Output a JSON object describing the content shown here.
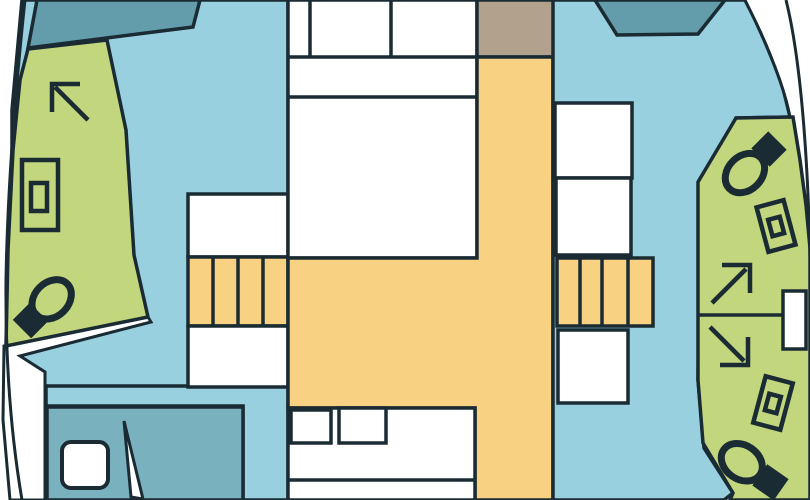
{
  "figure": {
    "kind": "boat-floor-plan",
    "icon_names": [
      "toilet-icon",
      "sink-icon",
      "shower-arrow-icon",
      "hatch-icon",
      "door-icon",
      "stairs",
      "window"
    ]
  },
  "colors": {
    "outline": "#1a2b33",
    "deck_white": "#ffffff",
    "cabin_blue": "#99d0e0",
    "window_teal": "#639dab",
    "berth_teal": "#7ab1bf",
    "head_green": "#c2d67e",
    "salon_yellow": "#f8d183",
    "hatch_tan": "#b2a18d"
  },
  "shapes": {
    "left_outer_deck": {
      "d": "M25,0 Q8,160 6,280 Q5,400 22,500 L0,500 L0,0 Z"
    },
    "left_hull_line": {
      "d": "M25,0 Q8,160 6,280 Q5,400 22,500"
    },
    "left_cabin": {
      "points": "22,0 288,0 288,500 243,500 243,406 46,406 46,386 12,386 12,110"
    },
    "left_gunwale": {
      "points": "4,346 148,317 151,322 20,356 45,372 45,500 10,500 3,420"
    },
    "left_head": {
      "points": "28,49 107,40 126,130 134,255 148,317 6,346 8,250 13,150 20,80"
    },
    "left_window": {
      "points": "37,0 200,0 193,27 28,48"
    },
    "left_cabin_divider": {
      "d": "M45,386 H188"
    },
    "left_berth": {
      "points": "47,407 243,407 243,500 47,500"
    },
    "berth_hatch": {
      "d": "M71,442 h28 a9,9 0 0 1 9,9 v28 a9,9 0 0 1 -9,9 h-28 a9,9 0 0 1 -9,-9 v-28 a9,9 0 0 1 9,-9 Z"
    },
    "berth_door": {
      "points": "124,421 131,497 143,499"
    },
    "left_landing_top": {
      "points": "188,194 288,194 288,257 188,257"
    },
    "left_stairs": {
      "points": "188,257 288,257 288,326 188,326"
    },
    "left_stairs_treads": {
      "d": "M213,257 V326 M238,257 V326 M263,257 V326"
    },
    "left_landing_bottom": {
      "points": "188,326 288,326 288,387 188,387"
    },
    "bed": {
      "points": "288,0 477,0 477,258 288,258"
    },
    "bed_lines": {
      "d": "M310,0 V57 M391,0 V57 M288,57 H477 M288,97 H477"
    },
    "bow_hatch": {
      "points": "477,0 558,0 558,57 477,57"
    },
    "saloon": {
      "points": "477,57 553,57 553,500 475,500 475,408 288,408 288,258 477,258"
    },
    "galley": {
      "points": "288,408 475,408 475,500 288,500"
    },
    "galley_divider": {
      "d": "M288,480 H475"
    },
    "galley_sink_left": {
      "points": "291,410 331,410 331,443 291,443"
    },
    "galley_sink_right": {
      "points": "339,408 386,408 386,443 339,443"
    },
    "right_cabin": {
      "points": "553,0 745,0 763,35 781,80 790,117 736,118 700,182 698,380 704,448 733,493 724,500 553,500"
    },
    "right_window": {
      "points": "595,0 725,0 698,34 617,35"
    },
    "right_step_upper": {
      "points": "555,103 632,103 632,178 555,178"
    },
    "right_step_lower": {
      "points": "556,178 631,178 631,255 556,255"
    },
    "right_stairs": {
      "points": "557,258 653,258 653,326 557,326"
    },
    "right_stairs_treads": {
      "d": "M580,258 V326 M602,258 V326 M628,258 V326"
    },
    "right_landing": {
      "points": "558,330 628,330 628,403 558,403"
    },
    "right_outer_deck": {
      "d": "M745,0 L810,0 L810,258 C806,170 788,70 745,0 Z"
    },
    "right_hull_inner_line": {
      "d": "M745,0 C760,30 783,80 790,117"
    },
    "right_hull_outer_line": {
      "d": "M786,0 C801,60 808,160 810,258"
    },
    "right_head": {
      "points": "736,118 793,117 800,160 806,205 810,248 810,500 730,500 733,493 703,443 698,380 698,182"
    },
    "right_head_divider": {
      "d": "M698,315 H786"
    },
    "right_head_door": {
      "points": "783,291 806,291 806,349 783,349"
    }
  }
}
